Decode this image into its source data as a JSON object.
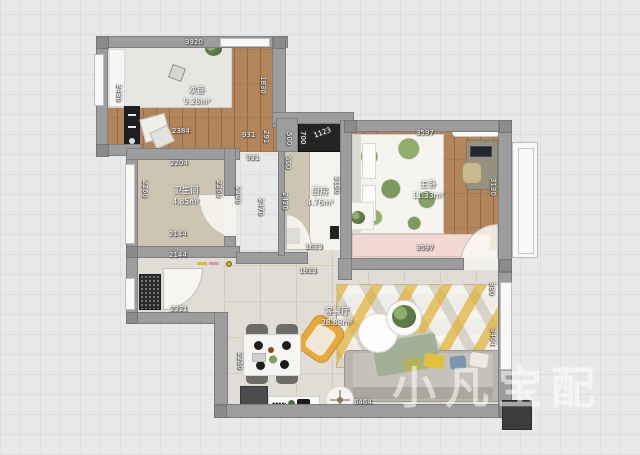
{
  "app": {
    "background": "#e9e9ea",
    "grid_color": "#dedee0"
  },
  "watermark": {
    "text": "小凡宝配"
  },
  "rooms": {
    "secondary_bedroom": {
      "name": "次卧",
      "area": "9.28m²"
    },
    "bathroom": {
      "name": "卫生间",
      "area": "4.85m²"
    },
    "kitchen": {
      "name": "厨房",
      "area": "4.76m²"
    },
    "master_bedroom": {
      "name": "主卧",
      "area": "11.33m²"
    },
    "living_dining": {
      "name": "客餐厅",
      "area": "28.88m²"
    }
  },
  "palette": {
    "wall": "#9d9d9e",
    "wood_floor": "#b2855b",
    "bath_floor": "#cdc4b2",
    "living_floor": "#e0ddd7",
    "rug_yellow": "#e6b93c",
    "sofa_gray": "#b9b5ae",
    "accent_chair_yellow": "#e8a93c",
    "bench_pink": "#f3d9d4",
    "fridge_black": "#242424"
  },
  "dimensions": [
    {
      "text": "3920",
      "x": 185,
      "y": 39,
      "rot": 0
    },
    {
      "text": "2430",
      "x": 122,
      "y": 84,
      "rot": 90
    },
    {
      "text": "1830",
      "x": 266,
      "y": 76,
      "rot": 90
    },
    {
      "text": "2384",
      "x": 172,
      "y": 128,
      "rot": 0
    },
    {
      "text": "931",
      "x": 242,
      "y": 132,
      "rot": 0
    },
    {
      "text": "291",
      "x": 269,
      "y": 130,
      "rot": 90
    },
    {
      "text": "500",
      "x": 292,
      "y": 132,
      "rot": 90
    },
    {
      "text": "700",
      "x": 306,
      "y": 131,
      "rot": 90
    },
    {
      "text": "1123",
      "x": 313,
      "y": 133,
      "rot": -20
    },
    {
      "text": "931",
      "x": 246,
      "y": 155,
      "rot": 0
    },
    {
      "text": "2204",
      "x": 170,
      "y": 160,
      "rot": 0
    },
    {
      "text": "2260",
      "x": 148,
      "y": 180,
      "rot": 90
    },
    {
      "text": "2260",
      "x": 222,
      "y": 180,
      "rot": 90
    },
    {
      "text": "2320",
      "x": 241,
      "y": 186,
      "rot": 90
    },
    {
      "text": "2470",
      "x": 264,
      "y": 198,
      "rot": 90
    },
    {
      "text": "500",
      "x": 291,
      "y": 156,
      "rot": 90
    },
    {
      "text": "2420",
      "x": 288,
      "y": 192,
      "rot": 90
    },
    {
      "text": "3150",
      "x": 340,
      "y": 176,
      "rot": 90
    },
    {
      "text": "1623",
      "x": 305,
      "y": 244,
      "rot": 0
    },
    {
      "text": "3597",
      "x": 416,
      "y": 130,
      "rot": 0
    },
    {
      "text": "3130",
      "x": 496,
      "y": 178,
      "rot": 90
    },
    {
      "text": "3597",
      "x": 416,
      "y": 245,
      "rot": 0
    },
    {
      "text": "2144",
      "x": 169,
      "y": 231,
      "rot": 0
    },
    {
      "text": "2144",
      "x": 169,
      "y": 252,
      "rot": 0
    },
    {
      "text": "1923",
      "x": 299,
      "y": 268,
      "rot": 0
    },
    {
      "text": "2321",
      "x": 170,
      "y": 306,
      "rot": 0
    },
    {
      "text": "2250",
      "x": 243,
      "y": 352,
      "rot": 90
    },
    {
      "text": "6464",
      "x": 354,
      "y": 399,
      "rot": 0
    },
    {
      "text": "3464",
      "x": 496,
      "y": 328,
      "rot": 90
    },
    {
      "text": "380",
      "x": 495,
      "y": 282,
      "rot": 90
    }
  ]
}
